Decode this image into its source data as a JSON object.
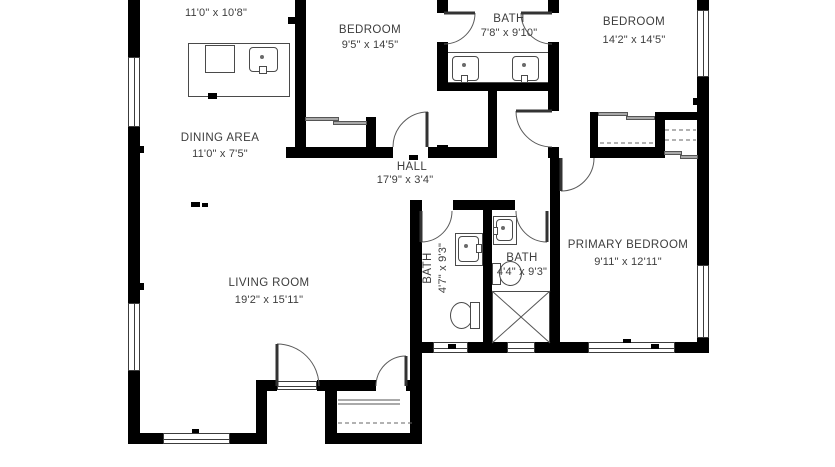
{
  "floorplan": {
    "rooms": {
      "kitchen": {
        "name": "KITCHEN",
        "dims": "11'0\" x 10'8\""
      },
      "bedroom1": {
        "name": "BEDROOM",
        "dims": "9'5\" x 14'5\""
      },
      "bath_top": {
        "name": "BATH",
        "dims": "7'8\" x 9'10\""
      },
      "bedroom2": {
        "name": "BEDROOM",
        "dims": "14'2\" x 14'5\""
      },
      "dining": {
        "name": "DINING AREA",
        "dims": "11'0\" x 7'5\""
      },
      "hall": {
        "name": "HALL",
        "dims": "17'9\" x 3'4\""
      },
      "living": {
        "name": "LIVING ROOM",
        "dims": "19'2\" x 15'11\""
      },
      "bath_a": {
        "name": "BATH",
        "dims": "4'7\" x 9'3\""
      },
      "bath_b": {
        "name": "BATH",
        "dims": "4'4\" x 9'3\""
      },
      "primary": {
        "name": "PRIMARY BEDROOM",
        "dims": "9'11\" x 12'11\""
      }
    },
    "colors": {
      "wall": "#000000",
      "background": "#ffffff",
      "fixture_line": "#4a4a4a",
      "label_text": "#3d3d3d",
      "sliding_door": "#a8a8a8"
    }
  }
}
